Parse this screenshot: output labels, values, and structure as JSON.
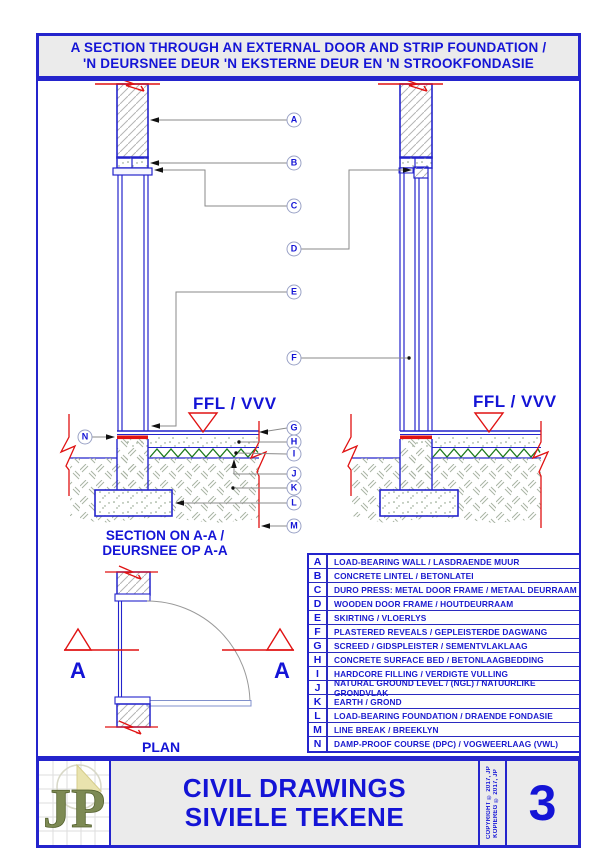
{
  "header": {
    "title_line1": "A SECTION THROUGH AN EXTERNAL DOOR AND STRIP FOUNDATION /",
    "title_line2": "'N DEURSNEE DEUR 'N EKSTERNE DEUR EN 'N STROOKFONDASIE"
  },
  "labels": {
    "ffl_left": "FFL / VVV",
    "ffl_right": "FFL / VVV",
    "section_caption_line1": "SECTION ON A-A /",
    "section_caption_line2": "DEURSNEE OP A-A",
    "plan_caption": "PLAN",
    "section_marker_left": "A",
    "section_marker_right": "A"
  },
  "callouts": [
    "A",
    "B",
    "C",
    "D",
    "E",
    "F",
    "G",
    "H",
    "I",
    "J",
    "K",
    "L",
    "M",
    "N"
  ],
  "legend": {
    "rows": [
      {
        "key": "A",
        "desc": "LOAD-BEARING WALL / LASDRAENDE MUUR"
      },
      {
        "key": "B",
        "desc": "CONCRETE LINTEL / BETONLATEI"
      },
      {
        "key": "C",
        "desc": "DURO PRESS: METAL DOOR FRAME / METAAL DEURRAAM"
      },
      {
        "key": "D",
        "desc": "WOODEN DOOR FRAME / HOUTDEURRAAM"
      },
      {
        "key": "E",
        "desc": "SKIRTING / VLOERLYS"
      },
      {
        "key": "F",
        "desc": "PLASTERED REVEALS / GEPLEISTERDE DAGWANG"
      },
      {
        "key": "G",
        "desc": "SCREED / GIDSPLEISTER / SEMENTVLAKLAAG"
      },
      {
        "key": "H",
        "desc": "CONCRETE SURFACE BED / BETONLAAGBEDDING"
      },
      {
        "key": "I",
        "desc": "HARDCORE FILLING / VERDIGTE VULLING"
      },
      {
        "key": "J",
        "desc": "NATURAL GROUND LEVEL / (NGL) / NATUURLIKE GRONDVLAK"
      },
      {
        "key": "K",
        "desc": "EARTH / GROND"
      },
      {
        "key": "L",
        "desc": "LOAD-BEARING FOUNDATION / DRAENDE FONDASIE"
      },
      {
        "key": "M",
        "desc": "LINE BREAK / BREEKLYN"
      },
      {
        "key": "N",
        "desc": "DAMP-PROOF COURSE (DPC) / VOGWEERLAAG (VWL)"
      }
    ]
  },
  "title_block": {
    "logo_text": "JP",
    "title_line1": "CIVIL DRAWINGS",
    "title_line2": "SIVIELE TEKENE",
    "copyright_line1": "COPYRIGHT © 2017, JP",
    "copyright_line2": "KOPIEREG © 2017, JP",
    "sheet_number": "3"
  },
  "colors": {
    "accent_blue": "#1414d6",
    "line_blue": "#2424cc",
    "marker_red": "#e01212",
    "hardcore_green": "#1c7a1c",
    "earth_hatch": "#a9b4a4",
    "leader_gray": "#8a8a8a",
    "logo_olive": "#7d8a54"
  }
}
